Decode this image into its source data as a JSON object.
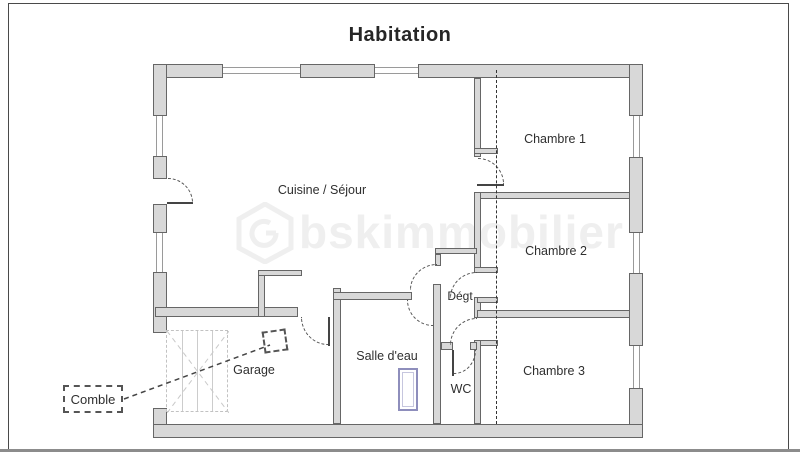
{
  "title": "Habitation",
  "watermark": {
    "text": "bskimmobilier",
    "logo": "hexagon-logo"
  },
  "rooms": {
    "cuisine_sejour": "Cuisine / Séjour",
    "chambre1": "Chambre 1",
    "chambre2": "Chambre 2",
    "chambre3": "Chambre 3",
    "degt": "Dégt",
    "salle_deau": "Salle d'eau",
    "wc": "WC",
    "garage": "Garage",
    "comble": "Comble"
  },
  "colors": {
    "wall_fill": "#d8d8d8",
    "wall_outline": "#666666",
    "window_line": "#9a9a9a",
    "door_line": "#444444",
    "section_line": "#333333",
    "stair_line": "#c9c9c9",
    "shower_outline": "#8e8ebc",
    "text": "#2f2f2f",
    "watermark": "#efefef",
    "frame_border": "#4a4a4a",
    "bottom_bar": "#8c8c8c"
  }
}
